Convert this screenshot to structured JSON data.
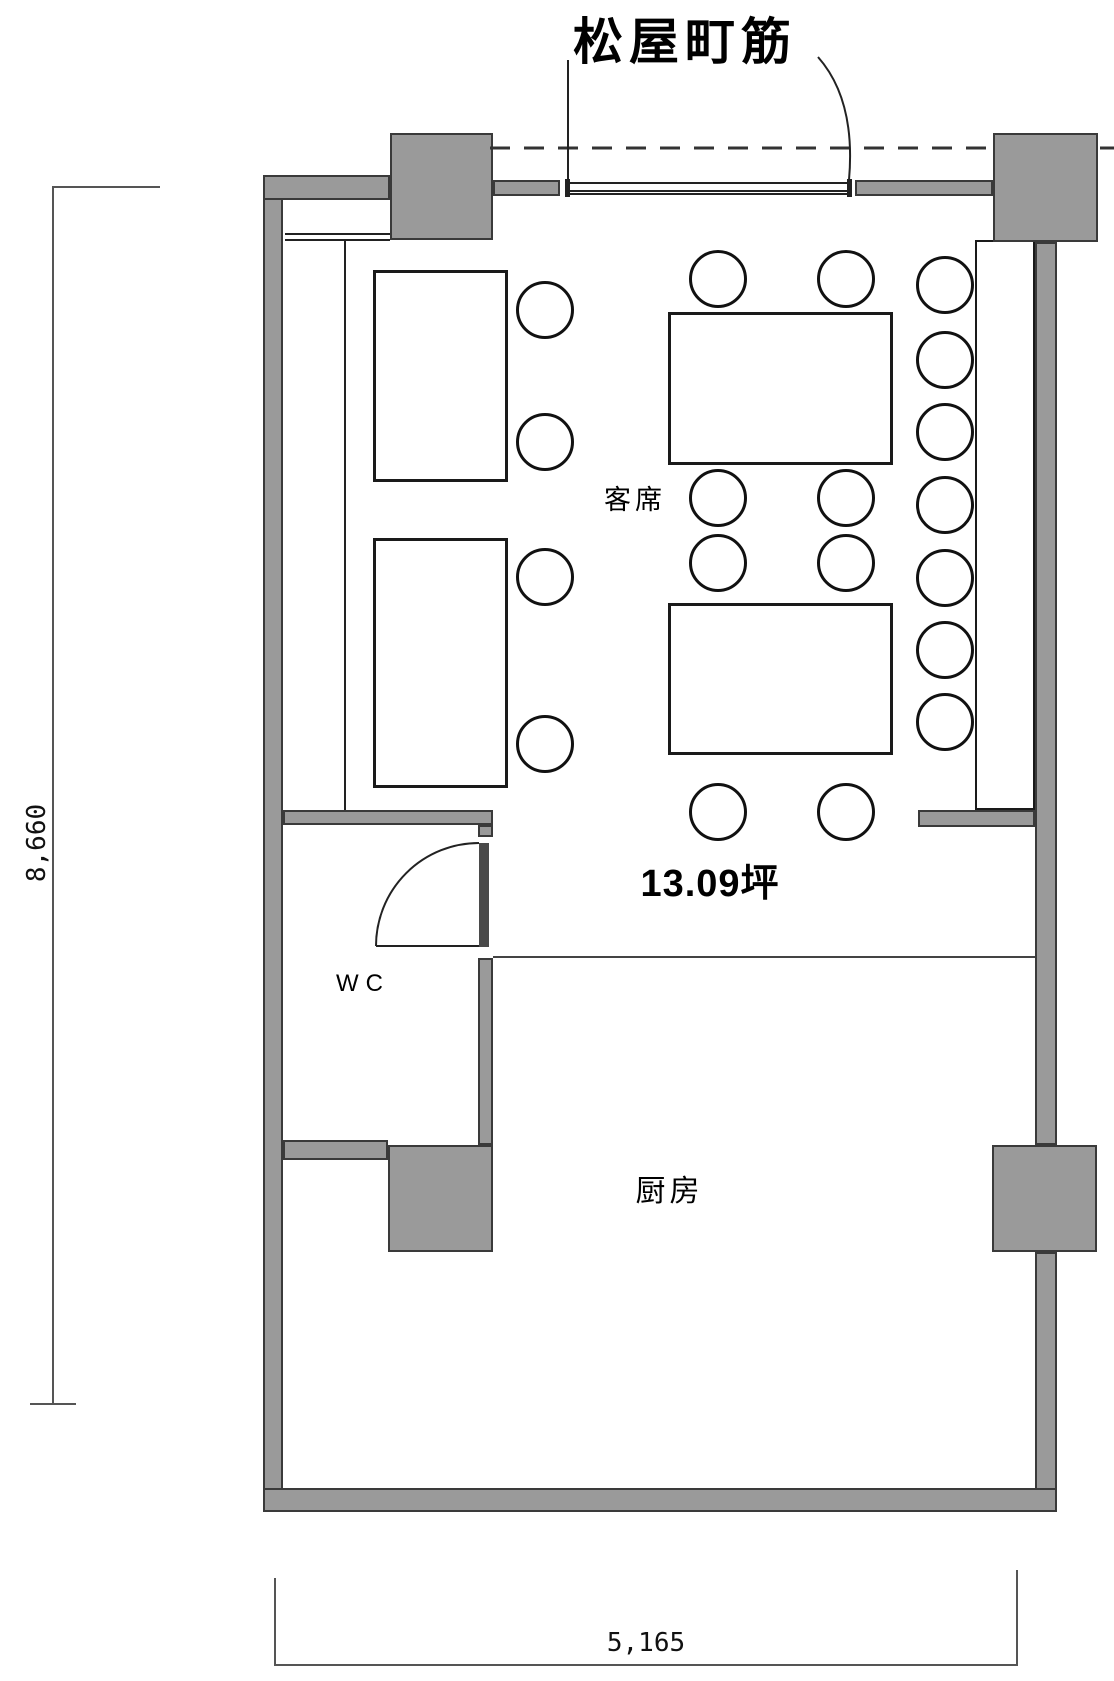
{
  "title": "restaurant floor plan",
  "labels": {
    "street": "松屋町筋",
    "seating": "客席",
    "area": "13.09坪",
    "wc": "WC",
    "kitchen": "厨房"
  },
  "dimensions": {
    "height_mm": "8,660",
    "width_mm": "5,165"
  },
  "colors": {
    "wall": "#9a9a9a",
    "line": "#222222",
    "background": "#ffffff"
  }
}
